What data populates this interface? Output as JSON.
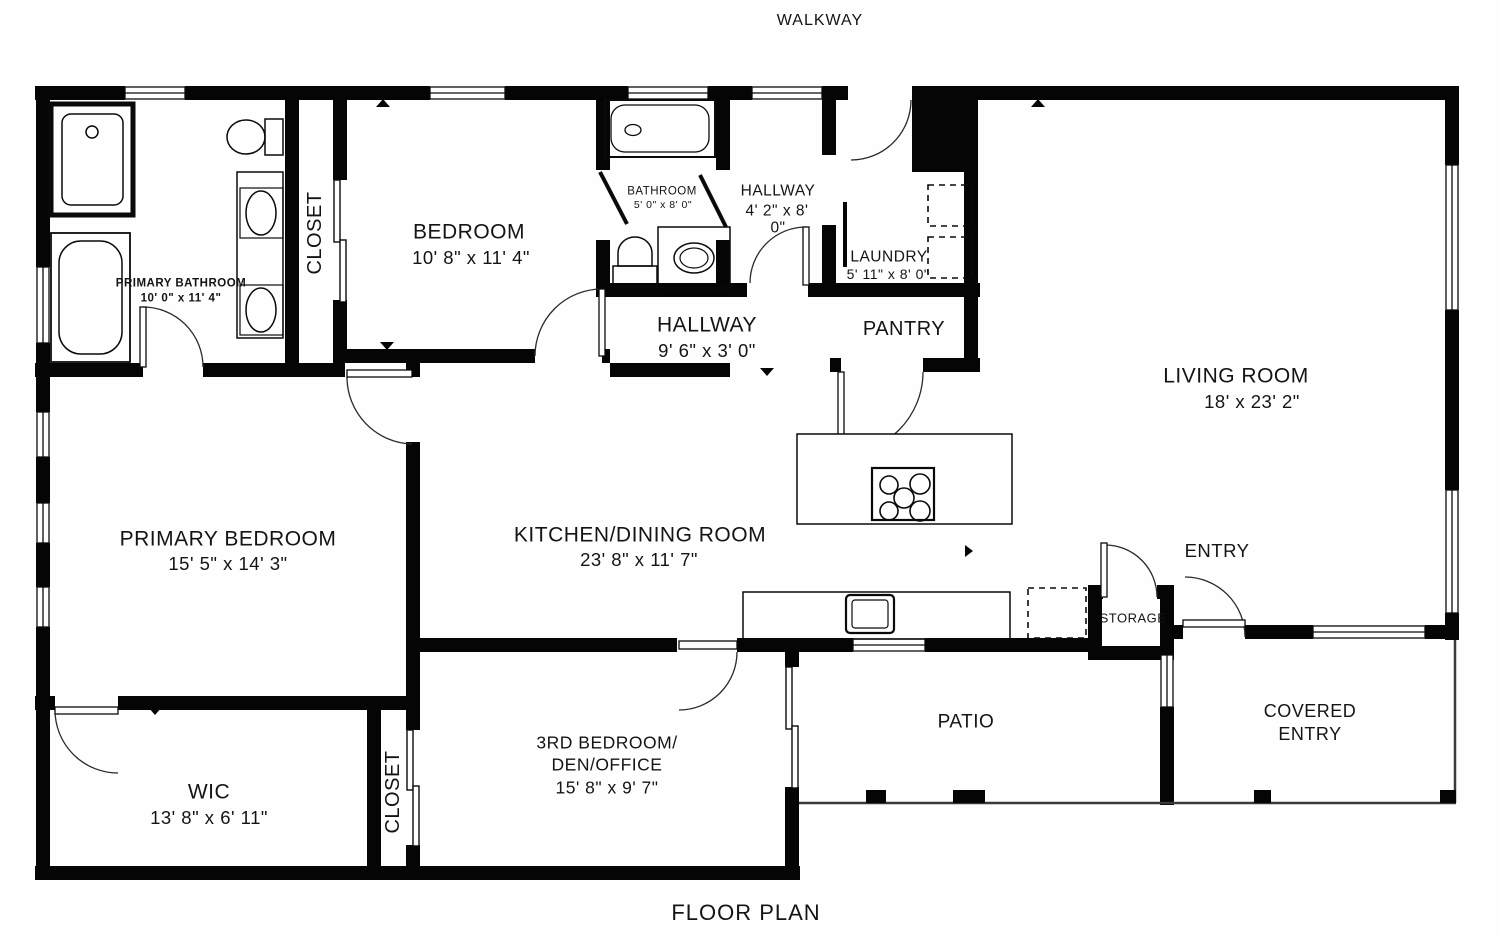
{
  "plan": {
    "top_label": "WALKWAY",
    "bottom_label": "FLOOR PLAN"
  },
  "rooms": {
    "primary_bathroom": {
      "name": "PRIMARY BATHROOM",
      "dims": "10' 0\" x 11' 4\""
    },
    "closet_upper": {
      "name": "CLOSET"
    },
    "bedroom": {
      "name": "BEDROOM",
      "dims": "10' 8\" x 11' 4\""
    },
    "bathroom": {
      "name": "BATHROOM",
      "dims": "5' 0\" x 8' 0\""
    },
    "hallway_upper": {
      "name": "HALLWAY",
      "dims_line1": "4' 2\" x 8'",
      "dims_line2": "0\""
    },
    "laundry": {
      "name": "LAUNDRY",
      "dims": "5' 11\" x 8' 0\""
    },
    "pantry": {
      "name": "PANTRY"
    },
    "hallway": {
      "name": "HALLWAY",
      "dims": "9' 6\" x 3' 0\""
    },
    "living_room": {
      "name": "LIVING ROOM",
      "dims": "18' x 23' 2\""
    },
    "primary_bedroom": {
      "name": "PRIMARY BEDROOM",
      "dims": "15' 5\" x 14' 3\""
    },
    "kitchen_dining": {
      "name": "KITCHEN/DINING ROOM",
      "dims": "23' 8\" x 11' 7\""
    },
    "entry": {
      "name": "ENTRY"
    },
    "storage": {
      "name": "STORAGE"
    },
    "wic": {
      "name": "WIC",
      "dims": "13' 8\" x 6' 11\""
    },
    "closet_lower": {
      "name": "CLOSET"
    },
    "third_bedroom": {
      "name_line1": "3RD BEDROOM/",
      "name_line2": "DEN/OFFICE",
      "dims": "15' 8\" x 9' 7\""
    },
    "patio": {
      "name": "PATIO"
    },
    "covered_entry": {
      "name_line1": "COVERED",
      "name_line2": "ENTRY"
    }
  },
  "colors": {
    "walls": "#000000",
    "background": "#fefefe",
    "thin_lines": "#333333",
    "text": "#141414"
  }
}
